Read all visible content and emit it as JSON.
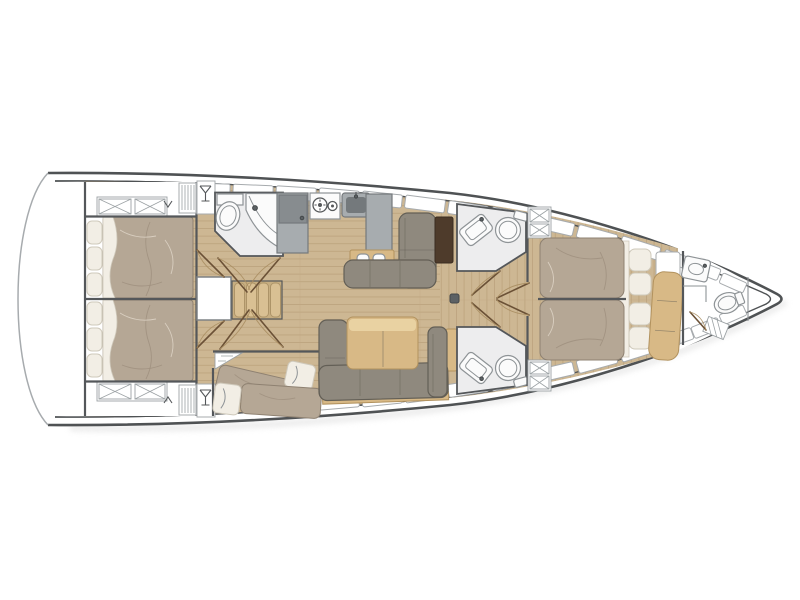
{
  "title": "Sailing yacht interior layout — deck floor plan, bow to the right",
  "diagram": {
    "type": "floorplan",
    "subject": "sailing-yacht-interior",
    "orientation": "bow-right",
    "summary": {
      "cabins": 4,
      "heads": 4,
      "berth_note": "2 aft doubles, 1 twin-berth guest cabin, forward owner's cabin"
    },
    "rooms": [
      {
        "id": "swim-platform",
        "label": "Stern swim platform / cockpit",
        "features": []
      },
      {
        "id": "aft-cabin-port",
        "label": "Aft double cabin (port)",
        "features": [
          "double-bed",
          "pillows",
          "storage-lockers"
        ]
      },
      {
        "id": "aft-cabin-starboard",
        "label": "Aft double cabin (starboard)",
        "features": [
          "double-bed",
          "pillows",
          "storage-lockers"
        ]
      },
      {
        "id": "aft-head",
        "label": "Aft head with basin and toilet",
        "features": [
          "toilet",
          "curved-basin-counter"
        ]
      },
      {
        "id": "companionway",
        "label": "Companionway steps",
        "features": [
          "4-steps",
          "locker-door"
        ]
      },
      {
        "id": "galley",
        "label": "Galley",
        "features": [
          "refrigerator",
          "two-burner-stove",
          "sink",
          "counter",
          "shelf-with-dishes"
        ]
      },
      {
        "id": "chart-area",
        "label": "Saloon L-sofa with chart table (port)",
        "features": [
          "l-sofa",
          "chart-table"
        ]
      },
      {
        "id": "saloon",
        "label": "Saloon dinette (starboard)",
        "features": [
          "u-sofa",
          "dining-table"
        ]
      },
      {
        "id": "guest-cabin",
        "label": "Guest cabin with two single berths",
        "features": [
          "two-single-berths",
          "pillows"
        ]
      },
      {
        "id": "forward-head-port",
        "label": "Forward head (port)",
        "features": [
          "angled-basin",
          "toilet"
        ]
      },
      {
        "id": "forward-head-starboard",
        "label": "Forward head (starboard)",
        "features": [
          "angled-basin",
          "toilet"
        ]
      },
      {
        "id": "owners-cabin",
        "label": "Forward owner's cabin",
        "features": [
          "island-double-bed",
          "four-pillows",
          "bench-seat",
          "shelves"
        ]
      },
      {
        "id": "bow-head",
        "label": "Bow head with shower",
        "features": [
          "basin",
          "toilet",
          "shower-tray"
        ]
      },
      {
        "id": "forepeak",
        "label": "Forepeak locker",
        "features": []
      }
    ],
    "icons": [
      "wine-glass-icon",
      "hanger-icon",
      "stove-burner-icon",
      "mast-post"
    ]
  },
  "colors": {
    "deck": "#ffffff",
    "hull_line": "#4f5254",
    "thin_line": "#a7abae",
    "wall": "#54575a",
    "wood": "#cdb793",
    "wood_plank": "#bca37d",
    "mattress": "#b5a795",
    "mattress_shade": "#9d8f7d",
    "mattress_line": "#8e8171",
    "linen": "#f2eee5",
    "linen_line": "#cfc9bb",
    "sofa": "#8f897e",
    "sofa_line": "#635f56",
    "table_wood": "#d8b986",
    "table_wood_light": "#e9d2a2",
    "table_wood_line": "#b2925e",
    "dark_table": "#4e3b2b",
    "counter": "#a7acaf",
    "counter_line": "#75797c",
    "appliance": "#878c8f",
    "sink_dark": "#74797c",
    "bath_floor": "#ededee",
    "fixture": "#fbfbfb",
    "fixture_line": "#8e9396",
    "hatch_line": "#9ba1a4",
    "door_line": "#6b5136",
    "arc_line": "#a88d60",
    "step": "#d9c093",
    "step_line": "#ad9468",
    "shadow": "#e2e2e2"
  }
}
